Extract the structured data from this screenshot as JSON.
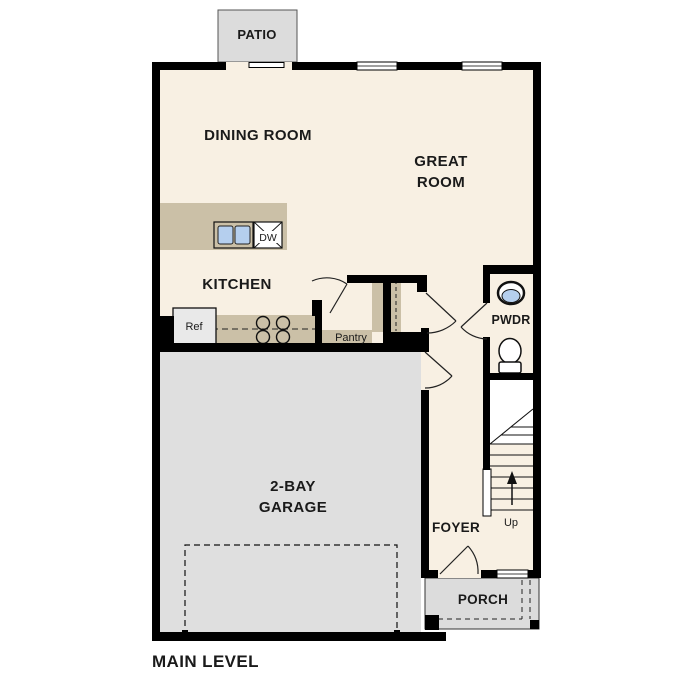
{
  "title": "MAIN LEVEL",
  "colors": {
    "floor": "#f8f0e3",
    "wall": "#000000",
    "counter": "#cbc0a7",
    "concrete": "#dcdcdc",
    "garage_floor": "#dfdfdf",
    "water": "#b5cfee",
    "fixture_white": "#ffffff",
    "appliance_gray": "#e9e9e9",
    "line_dark": "#1a1a1a"
  },
  "rooms": {
    "patio": "PATIO",
    "dining": "DINING ROOM",
    "great_line1": "GREAT",
    "great_line2": "ROOM",
    "kitchen": "KITCHEN",
    "powder": "PWDR",
    "pantry": "Pantry",
    "garage_line1": "2-BAY",
    "garage_line2": "GARAGE",
    "foyer": "FOYER",
    "porch": "PORCH"
  },
  "fixtures": {
    "refrigerator": "Ref",
    "dishwasher": "DW",
    "stairs_direction": "Up"
  }
}
